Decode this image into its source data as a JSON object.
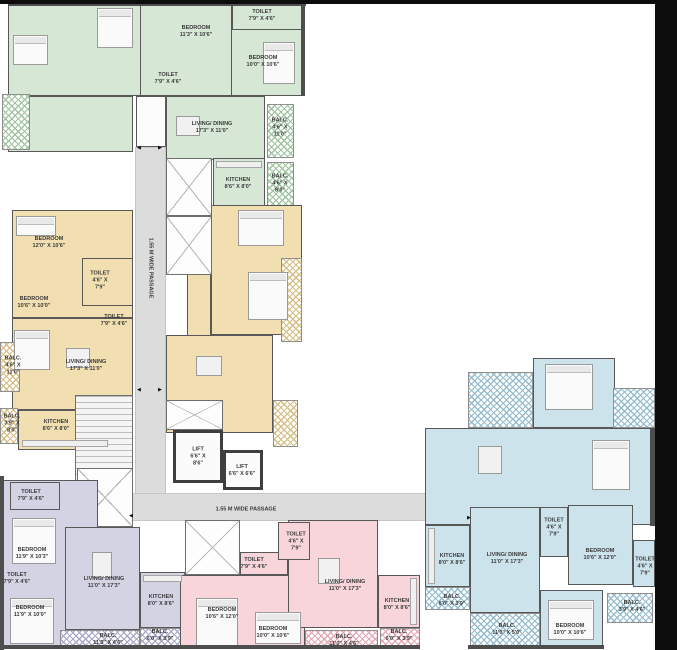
{
  "title": "Residential tower typical floor plan",
  "colors": {
    "unit_green": "#d7e7d6",
    "unit_yellow": "#f2dfb1",
    "unit_blue": "#cde3eb",
    "unit_pink": "#f7d5da",
    "unit_purple": "#d4d3e3",
    "hatch_green": "#9ec39e",
    "hatch_yellow": "#d5bd83",
    "hatch_blue": "#92bccd",
    "hatch_pink": "#e4a7b2",
    "hatch_purple": "#a9a7c9",
    "wall": "#4e4e4e",
    "passage": "#dcdcdd",
    "frame": "#0d0d0d",
    "label_text": "#3b3b3b"
  },
  "labels": [
    {
      "id": "green-bedroom1-label",
      "lines": [
        "BEDROOM",
        "11'3\" X 10'6\""
      ],
      "x": 196,
      "y": 32
    },
    {
      "id": "green-toilet1-label",
      "lines": [
        "TOILET",
        "7'9\" X 4'6\""
      ],
      "x": 262,
      "y": 16
    },
    {
      "id": "green-bedroom2-label",
      "lines": [
        "BEDROOM",
        "10'0\" X 10'6\""
      ],
      "x": 263,
      "y": 62
    },
    {
      "id": "green-toilet2-label",
      "lines": [
        "TOILET",
        "7'9\" X 4'6\""
      ],
      "x": 168,
      "y": 79
    },
    {
      "id": "green-living-label",
      "lines": [
        "LIVING/ DINING",
        "17'3\" X 11'0\""
      ],
      "x": 212,
      "y": 128
    },
    {
      "id": "green-balc1-label",
      "lines": [
        "BALC.",
        "4'6\" X",
        "11'0\""
      ],
      "x": 280,
      "y": 128
    },
    {
      "id": "green-kitchen-label",
      "lines": [
        "KITCHEN",
        "8'6\" X 8'0\""
      ],
      "x": 238,
      "y": 184
    },
    {
      "id": "green-balc2-label",
      "lines": [
        "BALC.",
        "4'6\" X",
        "8'0\""
      ],
      "x": 280,
      "y": 184
    },
    {
      "id": "yellow-bedroom1-label",
      "lines": [
        "BEDROOM",
        "12'0\" X 10'6\""
      ],
      "x": 49,
      "y": 243
    },
    {
      "id": "yellow-toilet1-label",
      "lines": [
        "TOILET",
        "4'6\" X",
        "7'9\""
      ],
      "x": 100,
      "y": 281
    },
    {
      "id": "yellow-bedroom2-label",
      "lines": [
        "BEDROOM",
        "10'6\" X 10'0\""
      ],
      "x": 34,
      "y": 303
    },
    {
      "id": "yellow-toilet2-label",
      "lines": [
        "TOILET",
        "7'9\" X 4'6\""
      ],
      "x": 114,
      "y": 321
    },
    {
      "id": "yellow-living-label",
      "lines": [
        "LIVING/ DINING",
        "17'3\" X 11'0\""
      ],
      "x": 86,
      "y": 366
    },
    {
      "id": "yellow-balc1-label",
      "lines": [
        "BALC.",
        "4'6\" X",
        "11'0\""
      ],
      "x": 13,
      "y": 366
    },
    {
      "id": "yellow-balc2-label",
      "lines": [
        "BALC.",
        "3'9\" X",
        "8'0\""
      ],
      "x": 12,
      "y": 424
    },
    {
      "id": "yellow-kitchen-label",
      "lines": [
        "KITCHEN",
        "8'6\" X 8'0\""
      ],
      "x": 56,
      "y": 426
    },
    {
      "id": "vertical-passage-label",
      "lines": [
        "1.55 M WIDE PASSAGE"
      ],
      "x": 150,
      "y": 268,
      "rot": true
    },
    {
      "id": "horizontal-passage-label",
      "lines": [
        "1.55 M WIDE PASSAGE"
      ],
      "x": 246,
      "y": 510
    },
    {
      "id": "lift1-label",
      "lines": [
        "LIFT",
        "6'6\" X",
        "8'6\""
      ],
      "x": 198,
      "y": 457
    },
    {
      "id": "lift2-label",
      "lines": [
        "LIFT",
        "6'6\" X 6'6\""
      ],
      "x": 242,
      "y": 471
    },
    {
      "id": "purple-toilet1-label",
      "lines": [
        "TOILET",
        "7'9\" X 4'6\""
      ],
      "x": 31,
      "y": 496
    },
    {
      "id": "purple-bedroom1-label",
      "lines": [
        "BEDROOM",
        "11'9\" X 10'3\""
      ],
      "x": 32,
      "y": 554
    },
    {
      "id": "purple-toilet2-label",
      "lines": [
        "TOILET",
        "7'9\" X 4'6\""
      ],
      "x": 17,
      "y": 579
    },
    {
      "id": "purple-bedroom2-label",
      "lines": [
        "BEDROOM",
        "11'9\" X 10'0\""
      ],
      "x": 30,
      "y": 612
    },
    {
      "id": "purple-living-label",
      "lines": [
        "LIVING/ DINING",
        "11'0\" X 17'3\""
      ],
      "x": 104,
      "y": 583
    },
    {
      "id": "purple-kitchen-label",
      "lines": [
        "KITCHEN",
        "8'0\" X 8'6\""
      ],
      "x": 161,
      "y": 601
    },
    {
      "id": "purple-balc1-label",
      "lines": [
        "BALC.",
        "11'0\" X 4'6\""
      ],
      "x": 108,
      "y": 640
    },
    {
      "id": "purple-balc2-label",
      "lines": [
        "BALC.",
        "6'0\" X 3'9\""
      ],
      "x": 160,
      "y": 636
    },
    {
      "id": "pink-toilet1-label",
      "lines": [
        "TOILET",
        "4'6\" X",
        "7'9\""
      ],
      "x": 296,
      "y": 542
    },
    {
      "id": "pink-toilet2-label",
      "lines": [
        "TOILET",
        "7'9\" X 4'6\""
      ],
      "x": 254,
      "y": 564
    },
    {
      "id": "pink-bedroom1-label",
      "lines": [
        "BEDROOM",
        "10'6\" X 12'0\""
      ],
      "x": 222,
      "y": 614
    },
    {
      "id": "pink-bedroom2-label",
      "lines": [
        "BEDROOM",
        "10'0\" X 10'6\""
      ],
      "x": 273,
      "y": 633
    },
    {
      "id": "pink-living-label",
      "lines": [
        "LIVING/ DINING",
        "11'0\" X 17'3\""
      ],
      "x": 345,
      "y": 586
    },
    {
      "id": "pink-kitchen-label",
      "lines": [
        "KITCHEN",
        "8'0\" X 8'6\""
      ],
      "x": 397,
      "y": 605
    },
    {
      "id": "pink-balc1-label",
      "lines": [
        "BALC.",
        "11'0\" X 4'6\""
      ],
      "x": 344,
      "y": 641
    },
    {
      "id": "pink-balc2-label",
      "lines": [
        "BALC.",
        "6'0\" X 3'9\""
      ],
      "x": 399,
      "y": 636
    },
    {
      "id": "blue-kitchen-label",
      "lines": [
        "KITCHEN",
        "8'0\" X 8'6\""
      ],
      "x": 452,
      "y": 560
    },
    {
      "id": "blue-living-label",
      "lines": [
        "LIVING/ DINING",
        "11'0\" X 17'3\""
      ],
      "x": 507,
      "y": 559
    },
    {
      "id": "blue-toilet1-label",
      "lines": [
        "TOILET",
        "4'6\" X",
        "7'9\""
      ],
      "x": 554,
      "y": 528
    },
    {
      "id": "blue-bedroom1-label",
      "lines": [
        "BEDROOM",
        "10'6\" X 12'0\""
      ],
      "x": 600,
      "y": 555
    },
    {
      "id": "blue-toilet2-label",
      "lines": [
        "TOILET",
        "4'6\" X",
        "7'9\""
      ],
      "x": 645,
      "y": 567
    },
    {
      "id": "blue-balc1-label",
      "lines": [
        "BALC.",
        "8'0\" X 3'9\""
      ],
      "x": 452,
      "y": 601
    },
    {
      "id": "blue-balc2-label",
      "lines": [
        "BALC.",
        "11'0\" X 5'0\""
      ],
      "x": 507,
      "y": 630
    },
    {
      "id": "blue-bedroom2-label",
      "lines": [
        "BEDROOM",
        "10'0\" X 10'6\""
      ],
      "x": 570,
      "y": 630
    },
    {
      "id": "blue-balc3-label",
      "lines": [
        "BALC.",
        "3'9\" X 4'6\""
      ],
      "x": 632,
      "y": 607
    }
  ],
  "arrows": [
    {
      "x": 139,
      "y": 148,
      "glyph": "◄"
    },
    {
      "x": 160,
      "y": 148,
      "glyph": "►"
    },
    {
      "x": 139,
      "y": 390,
      "glyph": "◄"
    },
    {
      "x": 160,
      "y": 390,
      "glyph": "►"
    },
    {
      "x": 469,
      "y": 518,
      "glyph": "►"
    },
    {
      "x": 131,
      "y": 516,
      "glyph": "◄"
    }
  ]
}
